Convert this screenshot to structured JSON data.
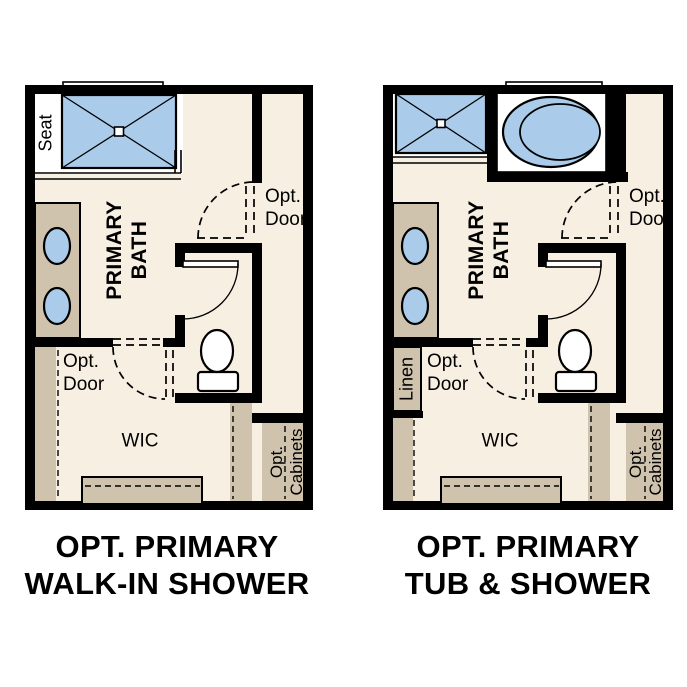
{
  "colors": {
    "wall": "#000000",
    "floor": "#f7efe2",
    "fixture": "#cfc3ae",
    "water": "#abcbea",
    "paper": "#ffffff",
    "ink": "#000000"
  },
  "plans": [
    {
      "caption": [
        "OPT. PRIMARY",
        "WALK-IN SHOWER"
      ],
      "labels": {
        "seat": "Seat",
        "room": [
          "PRIMARY",
          "BATH"
        ],
        "opt_door_upper": [
          "Opt.",
          "Door"
        ],
        "opt_door_lower": [
          "Opt.",
          "Door"
        ],
        "wic": "WIC",
        "cabinets": [
          "Opt.",
          "Cabinets"
        ]
      }
    },
    {
      "caption": [
        "OPT. PRIMARY",
        "TUB & SHOWER"
      ],
      "labels": {
        "linen": "Linen",
        "room": [
          "PRIMARY",
          "BATH"
        ],
        "opt_door_upper": [
          "Opt.",
          "Door"
        ],
        "opt_door_lower": [
          "Opt.",
          "Door"
        ],
        "wic": "WIC",
        "cabinets": [
          "Opt.",
          "Cabinets"
        ]
      }
    }
  ]
}
